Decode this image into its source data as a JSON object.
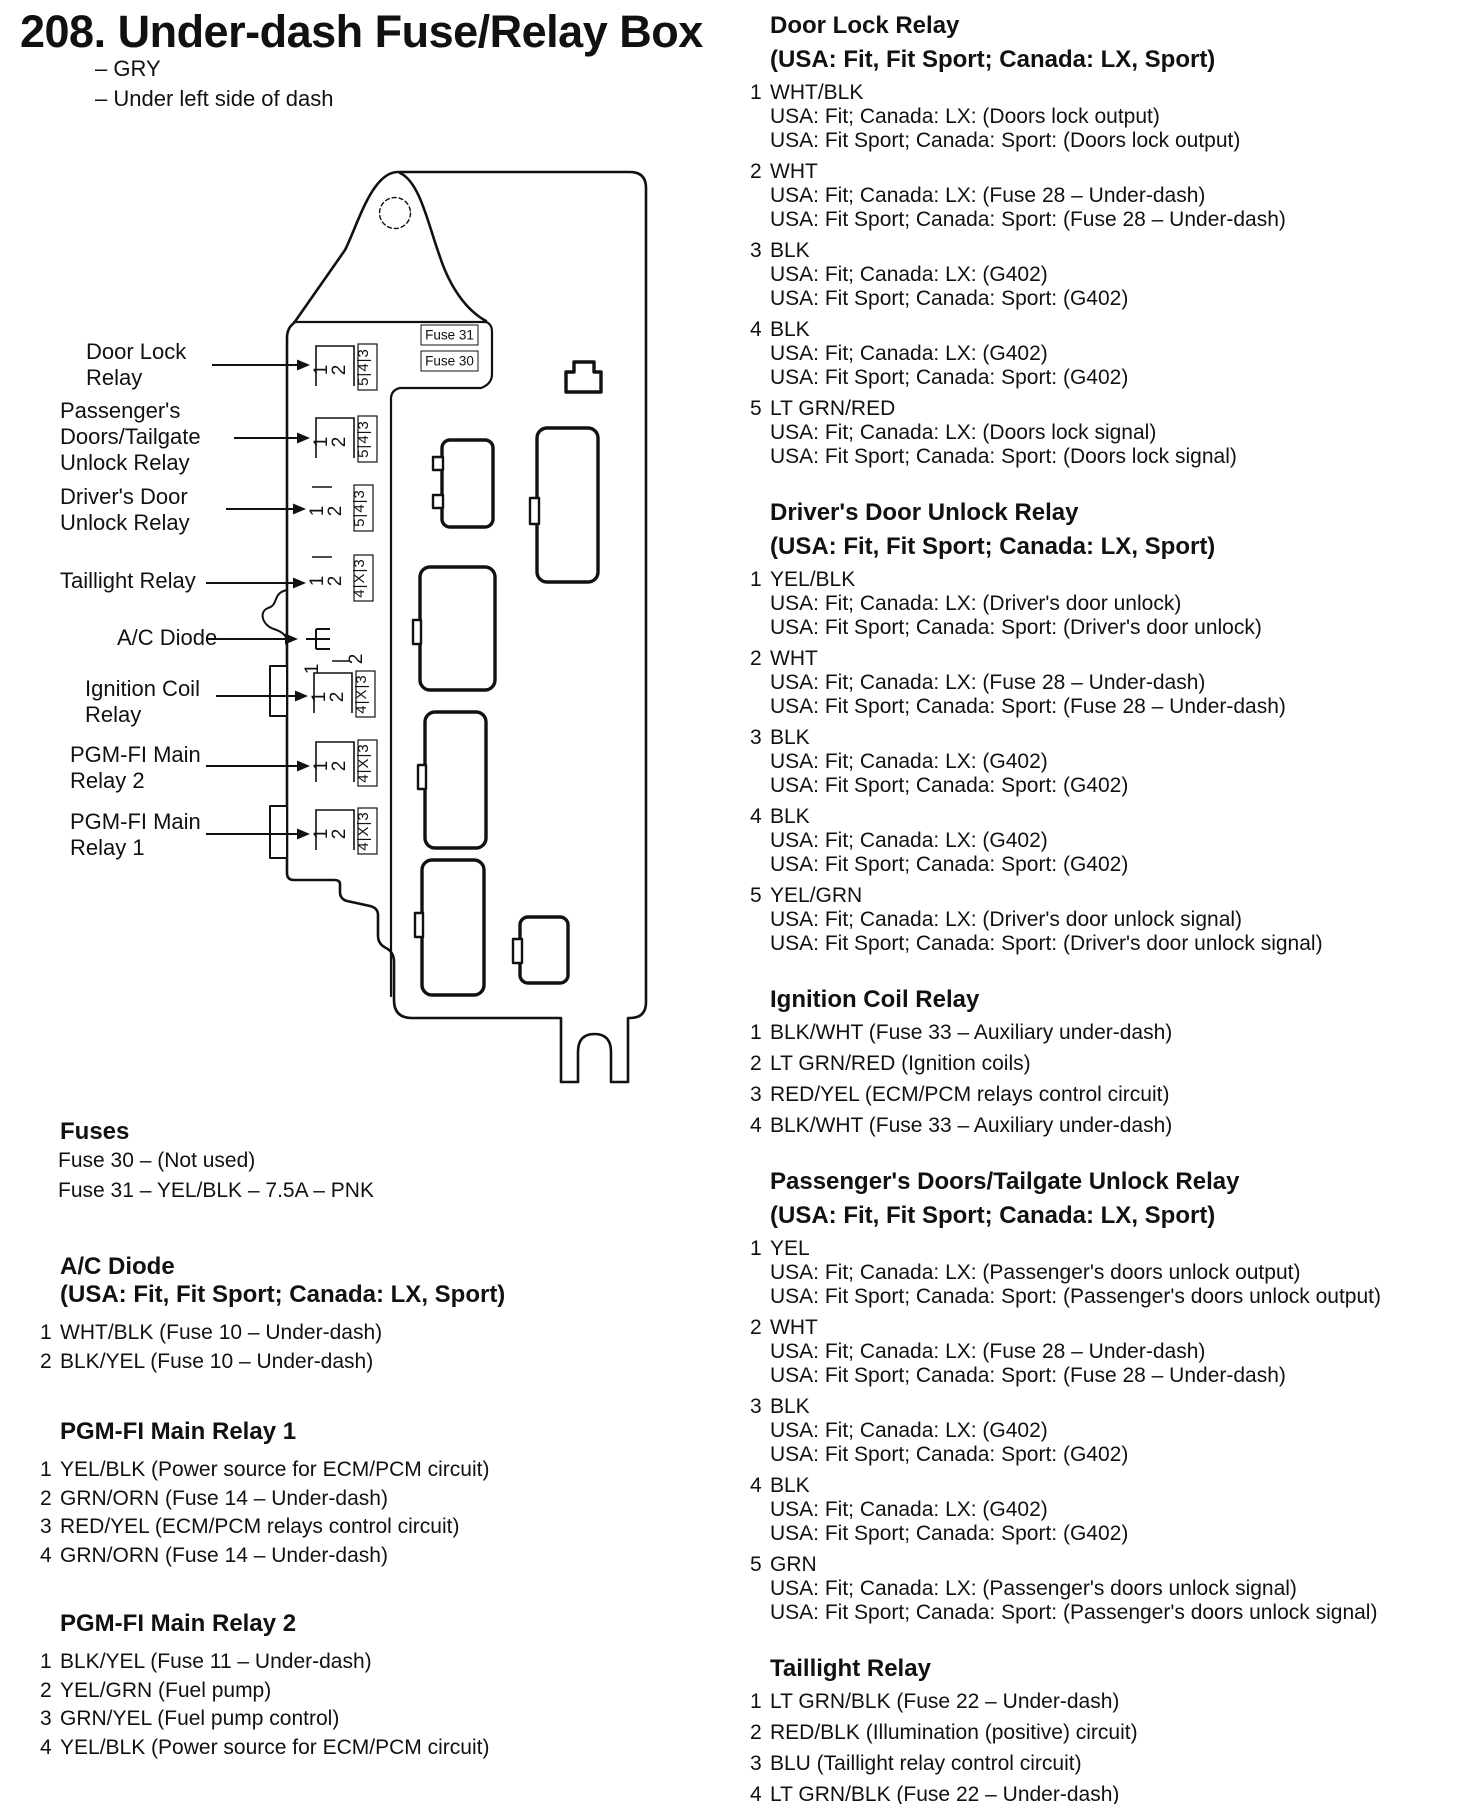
{
  "page": {
    "title": "208. Under-dash Fuse/Relay Box",
    "subtitles": [
      "– GRY",
      "– Under left side of dash"
    ]
  },
  "diagram": {
    "fuse_labels": [
      {
        "text": "Fuse 31",
        "x": 421,
        "y": 325
      },
      {
        "text": "Fuse 30",
        "x": 421,
        "y": 351
      }
    ],
    "callouts": [
      {
        "lines": [
          "Door Lock",
          "Relay"
        ],
        "lx": 86,
        "ty": 341,
        "ax1": 212,
        "ay": 365,
        "sx": 318,
        "sy": 348,
        "v": "box543"
      },
      {
        "lines": [
          "Passenger's",
          "Doors/Tailgate",
          "Unlock Relay"
        ],
        "lx": 60,
        "ty": 400,
        "ax1": 234,
        "ay": 438,
        "sx": 318,
        "sy": 420,
        "v": "box543"
      },
      {
        "lines": [
          "Driver's Door",
          "Unlock Relay"
        ],
        "lx": 60,
        "ty": 486,
        "ax1": 226,
        "ay": 509,
        "sx": 314,
        "sy": 489,
        "v": "line543"
      },
      {
        "lines": [
          "Taillight Relay"
        ],
        "lx": 60,
        "ty": 570,
        "ax1": 206,
        "ay": 583,
        "sx": 314,
        "sy": 559,
        "v": "line4x3"
      },
      {
        "lines": [
          "A/C Diode"
        ],
        "lx": 117,
        "ty": 627,
        "ax1": 208,
        "ay": 639,
        "sx": 306,
        "sy": 625,
        "v": "diode"
      },
      {
        "lines": [
          "Ignition Coil",
          "Relay"
        ],
        "lx": 85,
        "ty": 678,
        "ax1": 216,
        "ay": 696,
        "sx": 316,
        "sy": 675,
        "v": "box4x3"
      },
      {
        "lines": [
          "PGM-FI Main",
          "Relay 2"
        ],
        "lx": 70,
        "ty": 744,
        "ax1": 206,
        "ay": 766,
        "sx": 318,
        "sy": 744,
        "v": "box4x3"
      },
      {
        "lines": [
          "PGM-FI Main",
          "Relay 1"
        ],
        "lx": 70,
        "ty": 811,
        "ax1": 206,
        "ay": 834,
        "sx": 318,
        "sy": 812,
        "v": "box4x3"
      }
    ],
    "socket_strips": {
      "s543": "5|4|3",
      "s4x3": "4|X|3",
      "front": [
        "1",
        "2"
      ]
    }
  },
  "left_sections": [
    {
      "top": 1118,
      "heading": [
        "Fuses"
      ],
      "plain_lines": [
        "Fuse 30 – (Not used)",
        "Fuse 31 – YEL/BLK – 7.5A – PNK"
      ],
      "pins": []
    },
    {
      "top": 1253,
      "heading": [
        "A/C Diode",
        "(USA: Fit, Fit Sport; Canada: LX, Sport)"
      ],
      "plain_lines": [],
      "pins": [
        {
          "num": "1",
          "color": "WHT/BLK (Fuse 10 – Under-dash)",
          "subs": []
        },
        {
          "num": "2",
          "color": "BLK/YEL (Fuse 10 – Under-dash)",
          "subs": []
        }
      ]
    },
    {
      "top": 1418,
      "heading": [
        "PGM-FI Main Relay 1"
      ],
      "plain_lines": [],
      "pins": [
        {
          "num": "1",
          "color": "YEL/BLK (Power source for ECM/PCM circuit)",
          "subs": []
        },
        {
          "num": "2",
          "color": "GRN/ORN (Fuse 14 – Under-dash)",
          "subs": []
        },
        {
          "num": "3",
          "color": "RED/YEL (ECM/PCM relays control circuit)",
          "subs": []
        },
        {
          "num": "4",
          "color": "GRN/ORN (Fuse 14 – Under-dash)",
          "subs": []
        }
      ]
    },
    {
      "top": 1610,
      "heading": [
        "PGM-FI Main Relay 2"
      ],
      "plain_lines": [],
      "pins": [
        {
          "num": "1",
          "color": "BLK/YEL (Fuse 11 – Under-dash)",
          "subs": []
        },
        {
          "num": "2",
          "color": "YEL/GRN (Fuel pump)",
          "subs": []
        },
        {
          "num": "3",
          "color": "GRN/YEL (Fuel pump control)",
          "subs": []
        },
        {
          "num": "4",
          "color": "YEL/BLK (Power source for ECM/PCM circuit)",
          "subs": []
        }
      ]
    }
  ],
  "right_sections": [
    {
      "heading": [
        "Door Lock Relay",
        "(USA: Fit, Fit Sport; Canada: LX, Sport)"
      ],
      "pins": [
        {
          "num": "1",
          "color": "WHT/BLK",
          "subs": [
            "USA: Fit; Canada: LX: (Doors lock output)",
            "USA: Fit Sport; Canada: Sport: (Doors lock output)"
          ]
        },
        {
          "num": "2",
          "color": "WHT",
          "subs": [
            "USA: Fit; Canada: LX: (Fuse 28 – Under-dash)",
            "USA: Fit Sport; Canada: Sport: (Fuse 28 – Under-dash)"
          ]
        },
        {
          "num": "3",
          "color": "BLK",
          "subs": [
            "USA: Fit; Canada: LX: (G402)",
            "USA: Fit Sport; Canada: Sport: (G402)"
          ]
        },
        {
          "num": "4",
          "color": "BLK",
          "subs": [
            "USA: Fit; Canada: LX: (G402)",
            "USA: Fit Sport; Canada: Sport: (G402)"
          ]
        },
        {
          "num": "5",
          "color": "LT GRN/RED",
          "subs": [
            "USA: Fit; Canada: LX: (Doors lock signal)",
            "USA: Fit Sport; Canada: Sport: (Doors lock signal)"
          ]
        }
      ]
    },
    {
      "heading": [
        "Driver's Door Unlock Relay",
        "(USA: Fit, Fit Sport; Canada: LX, Sport)"
      ],
      "pins": [
        {
          "num": "1",
          "color": "YEL/BLK",
          "subs": [
            "USA: Fit; Canada: LX: (Driver's door unlock)",
            "USA: Fit Sport; Canada: Sport: (Driver's door unlock)"
          ]
        },
        {
          "num": "2",
          "color": "WHT",
          "subs": [
            "USA: Fit; Canada: LX: (Fuse 28 – Under-dash)",
            "USA: Fit Sport; Canada: Sport: (Fuse 28 – Under-dash)"
          ]
        },
        {
          "num": "3",
          "color": "BLK",
          "subs": [
            "USA: Fit; Canada: LX: (G402)",
            "USA: Fit Sport; Canada: Sport: (G402)"
          ]
        },
        {
          "num": "4",
          "color": "BLK",
          "subs": [
            "USA: Fit; Canada: LX: (G402)",
            "USA: Fit Sport; Canada: Sport: (G402)"
          ]
        },
        {
          "num": "5",
          "color": "YEL/GRN",
          "subs": [
            "USA: Fit; Canada: LX: (Driver's door unlock signal)",
            "USA: Fit Sport; Canada: Sport: (Driver's door unlock signal)"
          ]
        }
      ]
    },
    {
      "heading": [
        "Ignition Coil Relay"
      ],
      "pins": [
        {
          "num": "1",
          "color": "BLK/WHT (Fuse 33 – Auxiliary under-dash)",
          "subs": []
        },
        {
          "num": "2",
          "color": "LT GRN/RED (Ignition coils)",
          "subs": []
        },
        {
          "num": "3",
          "color": "RED/YEL (ECM/PCM relays control circuit)",
          "subs": []
        },
        {
          "num": "4",
          "color": "BLK/WHT (Fuse 33 – Auxiliary under-dash)",
          "subs": []
        }
      ]
    },
    {
      "heading": [
        "Passenger's Doors/Tailgate Unlock Relay",
        "(USA: Fit, Fit Sport; Canada: LX, Sport)"
      ],
      "pins": [
        {
          "num": "1",
          "color": "YEL",
          "subs": [
            "USA: Fit; Canada: LX: (Passenger's doors unlock output)",
            "USA: Fit Sport; Canada: Sport: (Passenger's doors unlock output)"
          ]
        },
        {
          "num": "2",
          "color": "WHT",
          "subs": [
            "USA: Fit; Canada: LX: (Fuse 28 – Under-dash)",
            "USA: Fit Sport; Canada: Sport: (Fuse 28 – Under-dash)"
          ]
        },
        {
          "num": "3",
          "color": "BLK",
          "subs": [
            "USA: Fit; Canada: LX: (G402)",
            "USA: Fit Sport; Canada: Sport: (G402)"
          ]
        },
        {
          "num": "4",
          "color": "BLK",
          "subs": [
            "USA: Fit; Canada: LX: (G402)",
            "USA: Fit Sport; Canada: Sport: (G402)"
          ]
        },
        {
          "num": "5",
          "color": "GRN",
          "subs": [
            "USA: Fit; Canada: LX: (Passenger's doors unlock signal)",
            "USA: Fit Sport; Canada: Sport: (Passenger's doors unlock signal)"
          ]
        }
      ]
    },
    {
      "heading": [
        "Taillight Relay"
      ],
      "pins": [
        {
          "num": "1",
          "color": "LT GRN/BLK (Fuse 22 – Under-dash)",
          "subs": []
        },
        {
          "num": "2",
          "color": "RED/BLK (Illumination (positive) circuit)",
          "subs": []
        },
        {
          "num": "3",
          "color": "BLU (Taillight relay control circuit)",
          "subs": []
        },
        {
          "num": "4",
          "color": "LT GRN/BLK (Fuse 22 – Under-dash)",
          "subs": []
        }
      ]
    }
  ]
}
